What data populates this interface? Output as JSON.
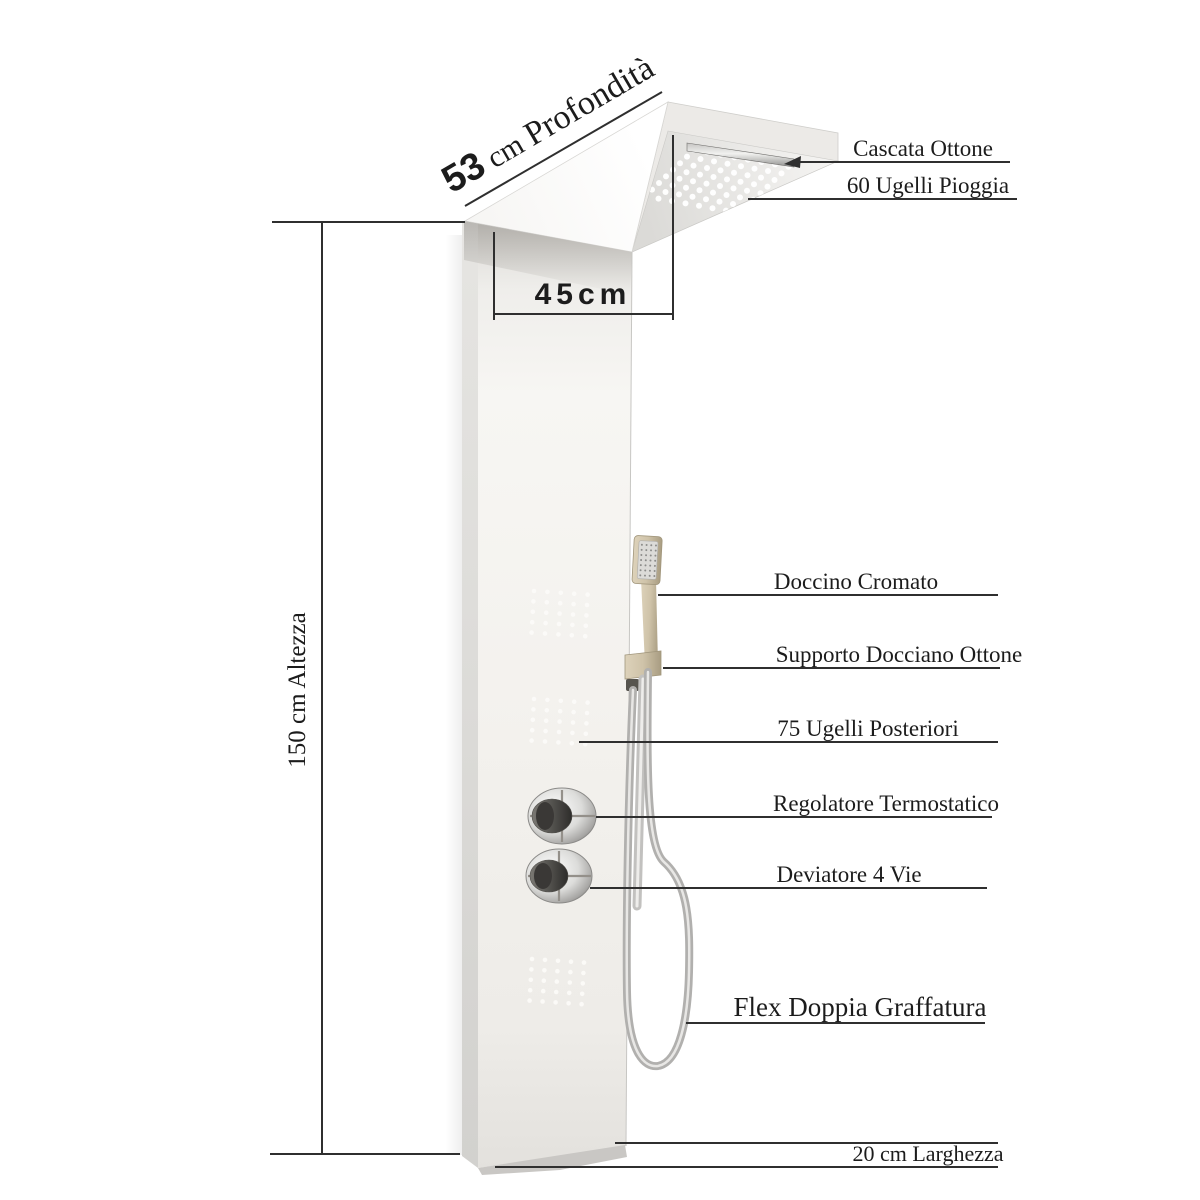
{
  "dimensions": {
    "depth_value": "53",
    "depth_unit": " cm ",
    "depth_word": "Profondità",
    "top_width": "45cm",
    "height": "150 cm Altezza",
    "bottom_width": "20 cm Larghezza"
  },
  "callouts": {
    "cascata": "Cascata Ottone",
    "pioggia": "60 Ugelli  Pioggia",
    "doccino": "Doccino Cromato",
    "supporto": "Supporto Docciano Ottone",
    "posteriori": "75 Ugelli Posteriori",
    "regolatore": "Regolatore Termostatico",
    "deviatore": "Deviatore 4 Vie",
    "flex": "Flex Doppia Graffatura"
  },
  "colors": {
    "line": "#2f2f2f",
    "text": "#1c1c1c",
    "brass": "#cfc3a9",
    "brass_dark": "#b2a689",
    "chrome": "#c9c9c7",
    "panel_white": "#f6f5f2"
  }
}
